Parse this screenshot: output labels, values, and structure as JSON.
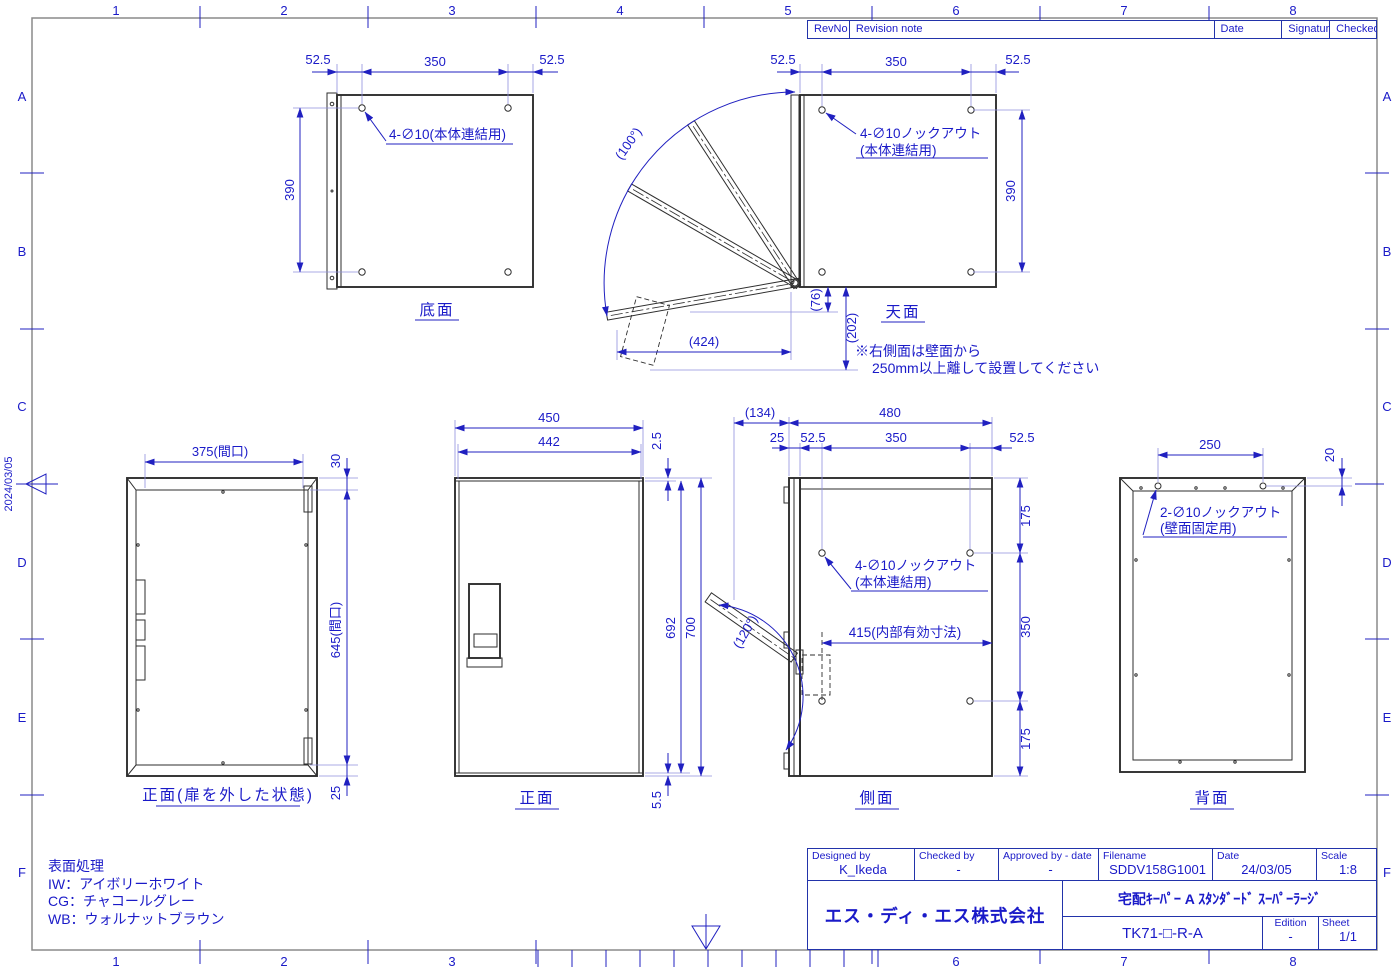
{
  "colors": {
    "line_blue": "#2020c0",
    "part_dark": "#2e2e2e",
    "frame_gray": "#8a8a8a"
  },
  "frame": {
    "cols": [
      "1",
      "2",
      "3",
      "4",
      "5",
      "6",
      "7",
      "8"
    ],
    "rows": [
      "A",
      "B",
      "C",
      "D",
      "E",
      "F"
    ],
    "date_stamp": "2024/03/05"
  },
  "revision_table": {
    "rev_no": "RevNo",
    "note": "Revision note",
    "date": "Date",
    "signature": "Signature",
    "checked": "Checked"
  },
  "title_block": {
    "designed_label": "Designed by",
    "designed": "K_Ikeda",
    "checked_label": "Checked by",
    "checked": "-",
    "approved_label": "Approved by - date",
    "approved": "-",
    "filename_label": "Filename",
    "filename": "SDDV158G1001",
    "date_label": "Date",
    "date": "24/03/05",
    "scale_label": "Scale",
    "scale": "1:8",
    "company": "エス・ディ・エス株式会社",
    "product_title": "宅配ｷｰﾊﾟｰ A ｽﾀﾝﾀﾞｰﾄﾞ ｽｰﾊﾟｰﾗｰｼﾞ",
    "part_number": "TK71-□-R-A",
    "edition_label": "Edition",
    "edition": "-",
    "sheet_label": "Sheet",
    "sheet": "1/1"
  },
  "notes": {
    "surface_title": "表面処理",
    "surface_iw": "IW：アイボリーホワイト",
    "surface_cg": "CG：チャコールグレー",
    "surface_wb": "WB：ウォルナットブラウン"
  },
  "views": {
    "bottom": {
      "title": "底面",
      "d52l": "52.5",
      "d350": "350",
      "d52r": "52.5",
      "d390": "390",
      "hole": "4-∅10(本体連結用)"
    },
    "top": {
      "title": "天面",
      "d52l": "52.5",
      "d350": "350",
      "d52r": "52.5",
      "d390": "390",
      "hole1": "4-∅10ノックアウト",
      "hole2": "(本体連結用)",
      "angle": "(100°)",
      "d76": "(76)",
      "d202": "(202)",
      "d424": "(424)",
      "note1": "※右側面は壁面から",
      "note2": "250mm以上離して設置してください"
    },
    "front_open": {
      "title": "正面(扉を外した状態)",
      "dw": "375(間口)",
      "d30": "30",
      "dh": "645(間口)",
      "d25": "25"
    },
    "front": {
      "title": "正面",
      "d450": "450",
      "d442": "442",
      "d25": "2.5",
      "d692": "692",
      "d700": "700",
      "d55": "5.5"
    },
    "side": {
      "title": "側面",
      "d134": "(134)",
      "d480": "480",
      "d25": "25",
      "d52l": "52.5",
      "d350": "350",
      "d52r": "52.5",
      "d175t": "175",
      "d350r": "350",
      "d175b": "175",
      "angle": "(120°)",
      "hole1": "4-∅10ノックアウト",
      "hole2": "(本体連結用)",
      "d415": "415(内部有効寸法)"
    },
    "back": {
      "title": "背面",
      "d250": "250",
      "d20": "20",
      "hole1": "2-∅10ノックアウト",
      "hole2": "(壁面固定用)"
    }
  }
}
